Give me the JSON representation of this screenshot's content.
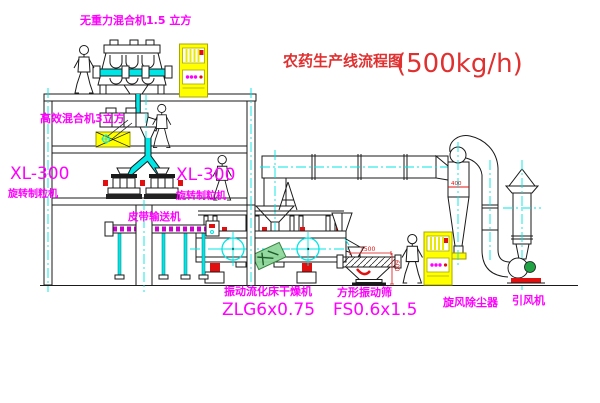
{
  "title": {
    "text": "农药生产线流程图",
    "capacity": "(500kg/h)"
  },
  "equipment_labels": {
    "top_mixer": "无重力混合机1.5 立方",
    "mid_mixer": "高效混合机3立方",
    "granulator_left": {
      "model": "XL-300",
      "name": "旋转制粒机"
    },
    "granulator_right": {
      "model": "XL-300",
      "name": "旋转制粒机"
    },
    "belt_conveyor": "皮带输送机",
    "fluid_bed_dryer": {
      "name": "振动流化床干燥机",
      "model": "ZLG6x0.75"
    },
    "vibrating_screen": {
      "name": "方形振动筛",
      "model": "FS0.6x1.5"
    },
    "cyclone": "旋风除尘器",
    "induced_draft_fan": "引风机"
  },
  "dimensions": {
    "screen_length": "1500",
    "screen_width": "600",
    "cyclone_mark": "400"
  },
  "colors": {
    "label_magenta": "#ff00ff",
    "title_red": "#e03030",
    "accent_red": "#e01010",
    "pipe_cyan": "#00e5e5",
    "cabinet_yellow": "#ffff00",
    "motor_green": "#1fa344",
    "line_black": "#1a1a1a",
    "stamp_green": "#8fd89a"
  }
}
